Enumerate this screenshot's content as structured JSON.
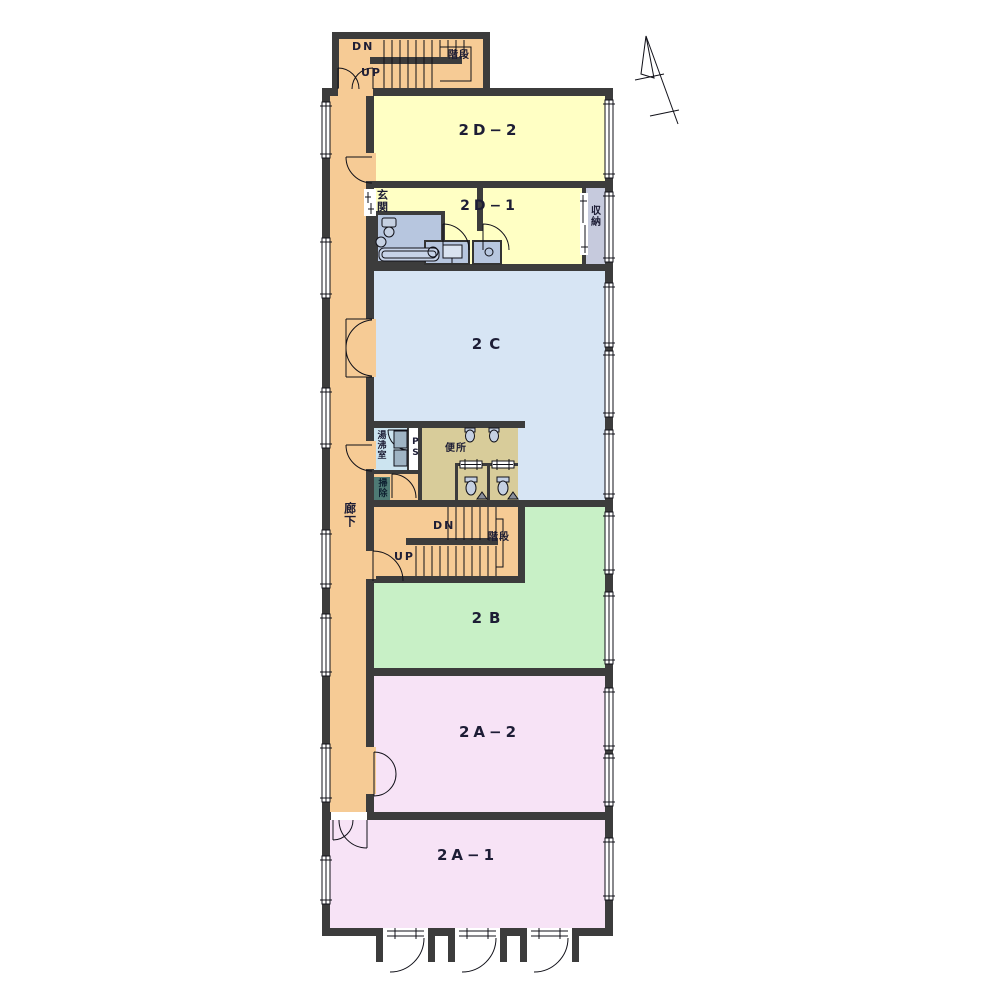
{
  "floorplan": {
    "rooms": [
      {
        "id": "2D-2",
        "label": "2D−2",
        "fill": "#FFFFC4"
      },
      {
        "id": "2D-1",
        "label": "2D−1",
        "fill": "#FFFFC4"
      },
      {
        "id": "2C",
        "label": "2C",
        "fill": "#D7E5F4"
      },
      {
        "id": "2B",
        "label": "2B",
        "fill": "#C8F0C6"
      },
      {
        "id": "2A-2",
        "label": "2A−2",
        "fill": "#F7E3F6"
      },
      {
        "id": "2A-1",
        "label": "2A−1",
        "fill": "#F7E3F6"
      }
    ],
    "corridor": {
      "label": "廊下",
      "fill": "#F6CB95"
    },
    "stairs": {
      "top": {
        "dn": "DN",
        "up": "UP",
        "name": "階段"
      },
      "middle": {
        "dn": "DN",
        "up": "UP",
        "name": "階段"
      }
    },
    "service": {
      "entrance": "玄関",
      "storage": "収納",
      "toilet": "便所",
      "hot_water_room": "湯沸室",
      "pipe_space": "PS",
      "cleaning_closet": "掃除"
    },
    "colors": {
      "wall": "#3C3C3C",
      "corridor": "#F6CB95",
      "room_yellow": "#FFFFC4",
      "room_blue": "#D7E5F4",
      "room_green": "#C8F0C6",
      "room_pink": "#F7E3F6",
      "toilet": "#D8CC9A",
      "bath_unit": "#B7C6DF",
      "storage": "#C6CADD",
      "hot_water": "#CCE4F0",
      "closet": "#4E7A74"
    }
  }
}
